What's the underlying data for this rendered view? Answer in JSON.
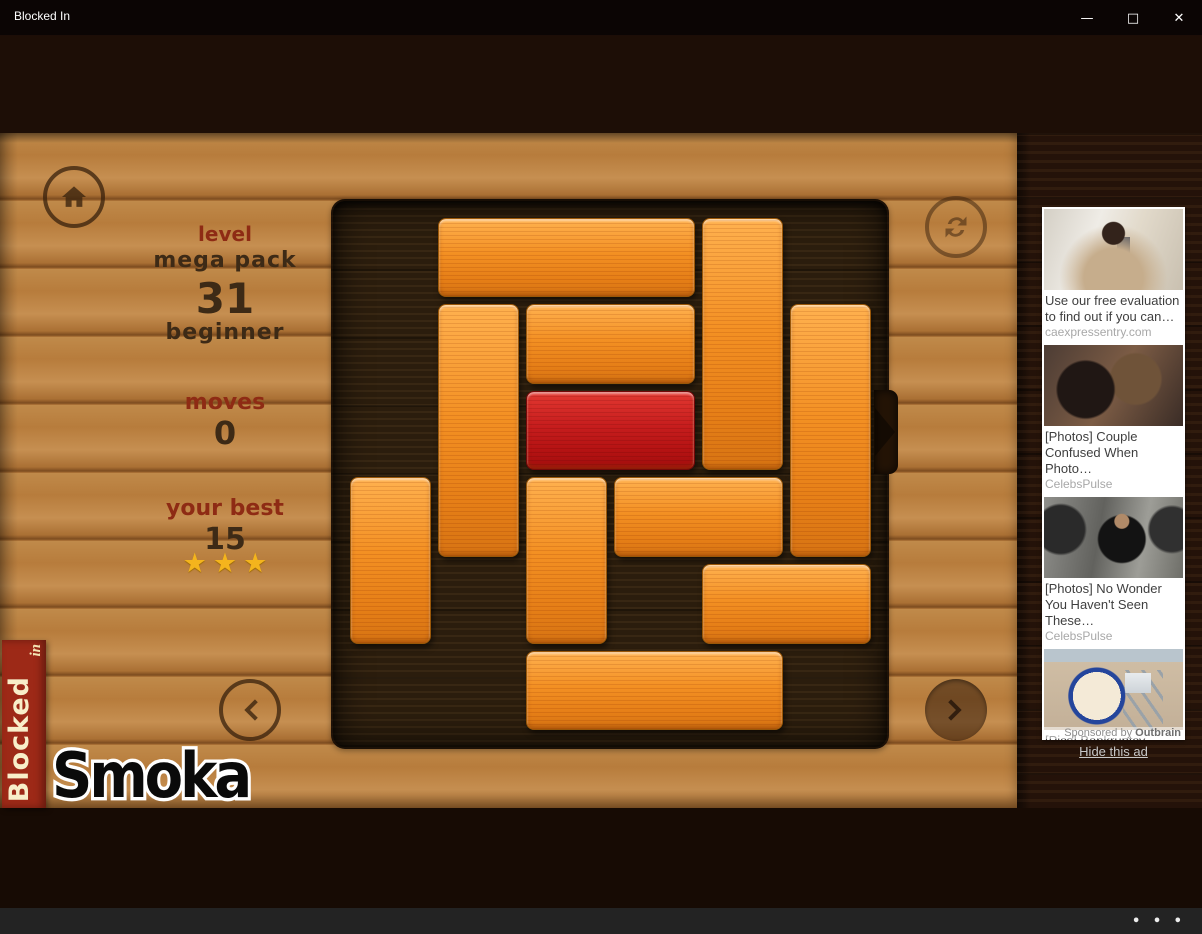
{
  "window": {
    "title": "Blocked In",
    "icons": {
      "minimize": "—",
      "maximize": "□",
      "close": "✕",
      "more": "• • •"
    }
  },
  "hud": {
    "level_label": "level",
    "pack_name": "mega pack",
    "level_number": "31",
    "difficulty": "beginner",
    "moves_label": "moves",
    "moves_value": "0",
    "best_label": "your best",
    "best_value": "15",
    "stars_earned": 3,
    "star_glyph": "★"
  },
  "board": {
    "rows": 6,
    "cols": 6,
    "exit_row": 2,
    "blocks": [
      {
        "row": 0,
        "col": 1,
        "len": 3,
        "dir": "h",
        "type": "normal"
      },
      {
        "row": 0,
        "col": 4,
        "len": 3,
        "dir": "v",
        "type": "normal"
      },
      {
        "row": 1,
        "col": 1,
        "len": 3,
        "dir": "v",
        "type": "normal"
      },
      {
        "row": 1,
        "col": 2,
        "len": 2,
        "dir": "h",
        "type": "normal"
      },
      {
        "row": 1,
        "col": 5,
        "len": 3,
        "dir": "v",
        "type": "normal"
      },
      {
        "row": 2,
        "col": 2,
        "len": 2,
        "dir": "h",
        "type": "target"
      },
      {
        "row": 3,
        "col": 0,
        "len": 2,
        "dir": "v",
        "type": "normal"
      },
      {
        "row": 3,
        "col": 2,
        "len": 2,
        "dir": "v",
        "type": "normal"
      },
      {
        "row": 3,
        "col": 3,
        "len": 2,
        "dir": "h",
        "type": "normal"
      },
      {
        "row": 4,
        "col": 4,
        "len": 2,
        "dir": "h",
        "type": "normal"
      },
      {
        "row": 5,
        "col": 2,
        "len": 3,
        "dir": "h",
        "type": "normal"
      }
    ]
  },
  "branding": {
    "banner_word": "Blocked",
    "banner_sub": "in",
    "watermark": "Smoka"
  },
  "ads": {
    "items": [
      {
        "title": "Use our free evaluation to find out if you can…",
        "source": "caexpressentry.com"
      },
      {
        "title": "[Photos] Couple Confused When Photo…",
        "source": "CelebsPulse"
      },
      {
        "title": "[Photos] No Wonder You Haven't Seen These…",
        "source": "CelebsPulse"
      },
      {
        "title": "[Pics] Bankruptcy Bound. The Final…",
        "source": "UnpuzzleFinance"
      }
    ],
    "sponsored_prefix": "Sponsored by",
    "sponsor_brand": "Outbrain",
    "hide_label": "Hide this ad"
  },
  "colors": {
    "accent_red": "#9d2917",
    "block_orange": "#f39023",
    "target_red": "#c61d1d",
    "star_gold": "#f4b41d"
  }
}
